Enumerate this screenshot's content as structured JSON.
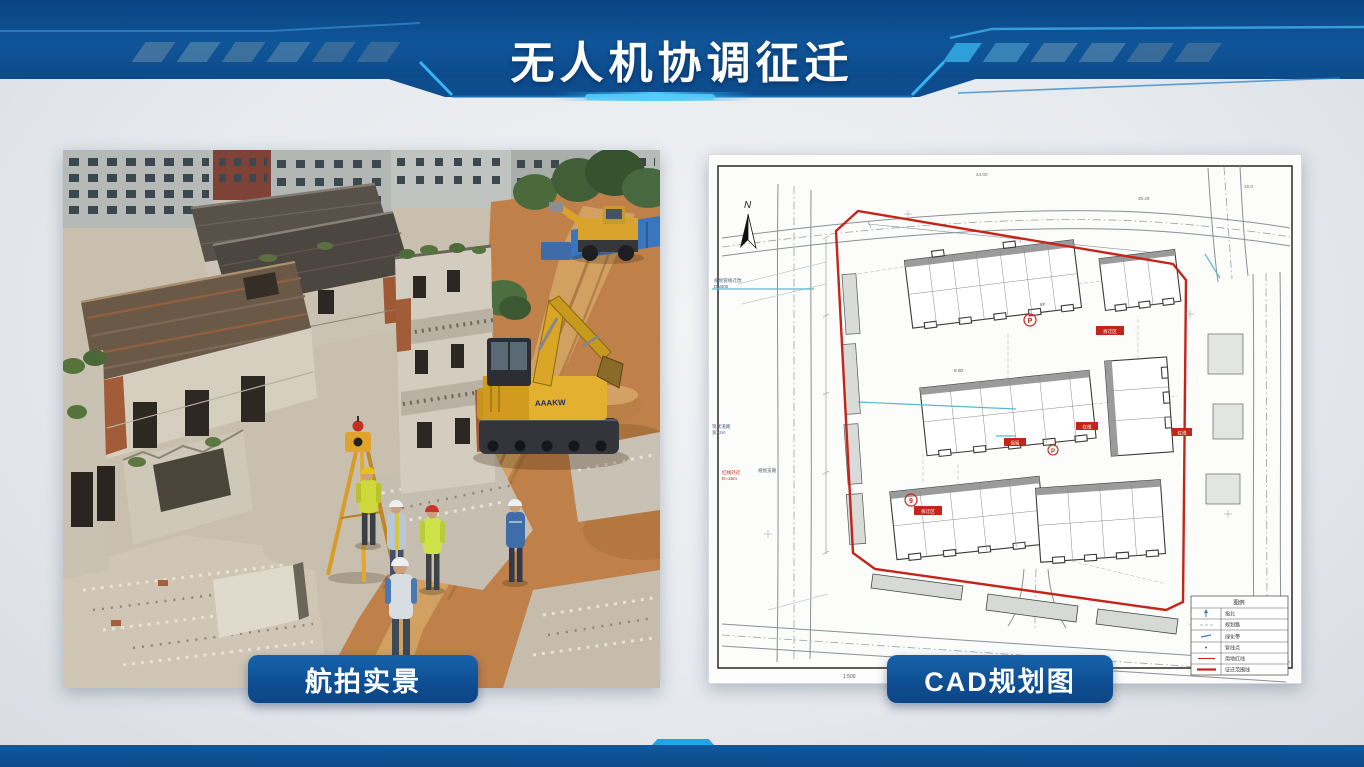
{
  "slide": {
    "title": "无人机协调征迁",
    "accent": {
      "header_blue": "#0e5095",
      "header_blue_dark": "#0a4282",
      "cyan_glow": "#3cc0f5",
      "badge_blue": "#10508f",
      "footer_blue": "#0d5295",
      "background": "#e8ebee",
      "cad_red": "#c3251b"
    }
  },
  "figures": {
    "aerial": {
      "caption": "航拍实景",
      "machine_label": "AAAKW"
    },
    "cad": {
      "caption": "CAD规划图",
      "north_label": "N",
      "scale_note": "1:500",
      "legend": {
        "title": "图例",
        "rows": [
          {
            "label": "指北"
          },
          {
            "label": "规划路"
          },
          {
            "label": "绿化带"
          },
          {
            "label": "管线点"
          },
          {
            "label": "用地红线"
          },
          {
            "label": "征迁范围线"
          }
        ]
      },
      "markers": {
        "p1": "P",
        "p2": "P",
        "num": "9",
        "box1": "拆迁区",
        "box2": "红线",
        "box3": "保留",
        "box4": "拆迁区",
        "box5": "红线"
      },
      "annotations": {
        "a1": "规划管线迁改",
        "a2": "DN300",
        "a3": "现状道路",
        "a4": "宽12m",
        "a5": "规划支路",
        "a6": "24.00",
        "a7": "35.26",
        "a8": "18.0",
        "a9": "9.00",
        "a10": "6F",
        "a11": "红线外迁",
        "a12": "D=15m"
      }
    }
  }
}
